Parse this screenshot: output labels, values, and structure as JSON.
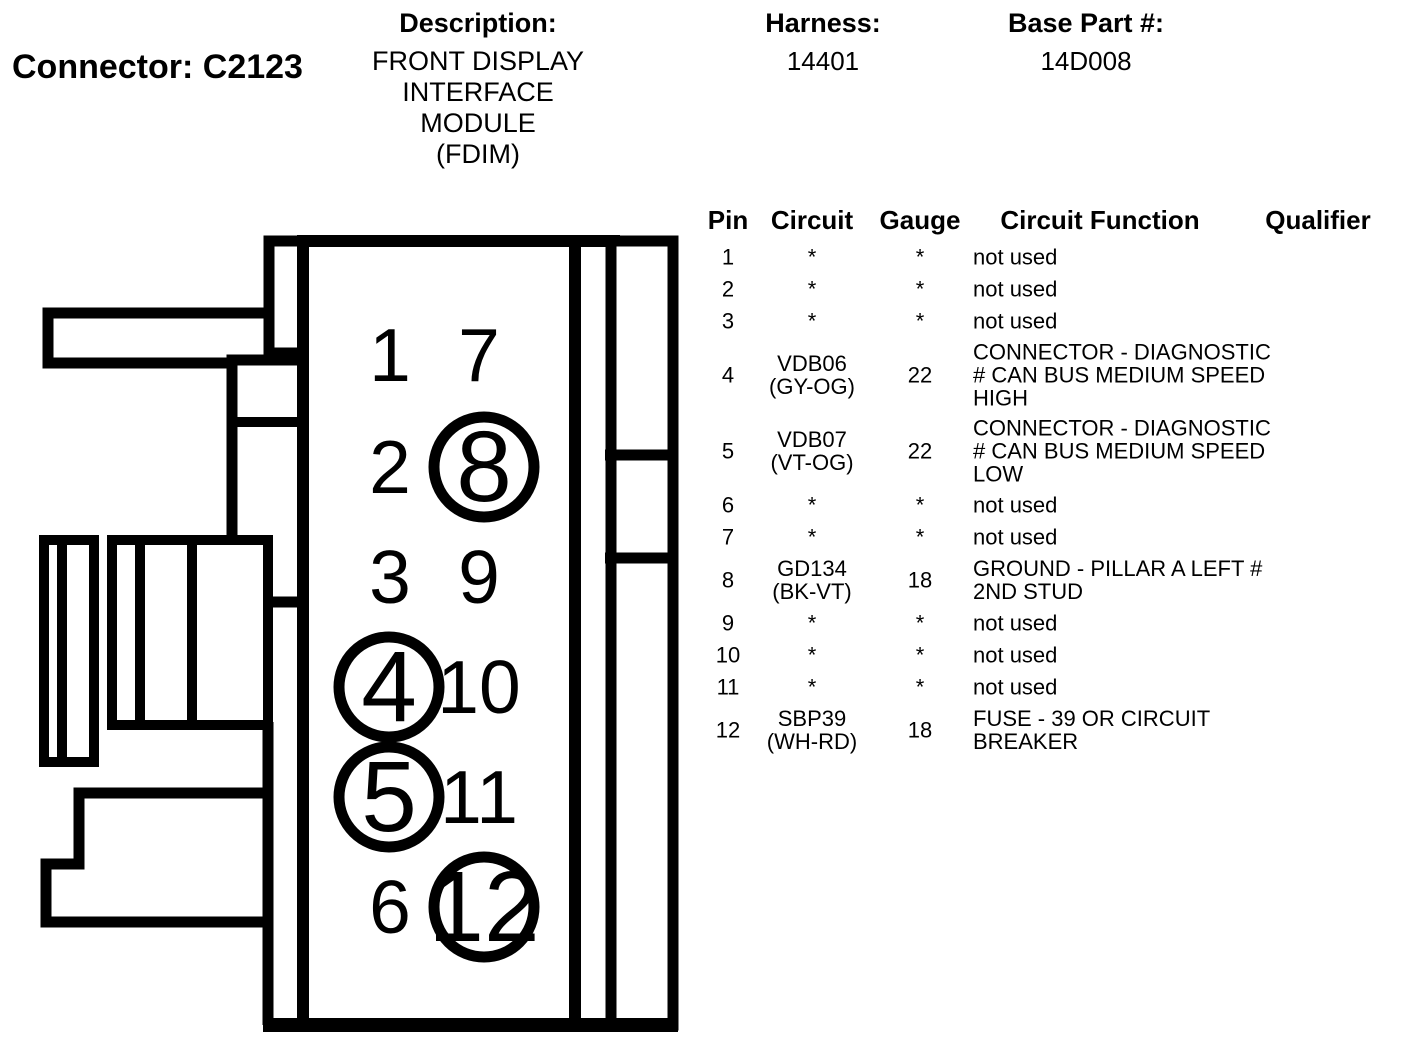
{
  "colors": {
    "ink": "#000000",
    "background": "#ffffff"
  },
  "header": {
    "connector_label": "Connector: C2123",
    "description_label": "Description:",
    "description_lines": [
      "FRONT DISPLAY",
      "INTERFACE MODULE",
      "(FDIM)"
    ],
    "harness_label": "Harness:",
    "harness_value": "14401",
    "base_part_label": "Base Part #:",
    "base_part_value": "14D008"
  },
  "pin_table": {
    "columns": [
      "Pin",
      "Circuit",
      "Gauge",
      "Circuit Function",
      "Qualifier"
    ],
    "rows": [
      {
        "pin": "1",
        "circuit_lines": [
          "*"
        ],
        "gauge": "*",
        "function_lines": [
          "not used"
        ],
        "qualifier": ""
      },
      {
        "pin": "2",
        "circuit_lines": [
          "*"
        ],
        "gauge": "*",
        "function_lines": [
          "not used"
        ],
        "qualifier": ""
      },
      {
        "pin": "3",
        "circuit_lines": [
          "*"
        ],
        "gauge": "*",
        "function_lines": [
          "not used"
        ],
        "qualifier": ""
      },
      {
        "pin": "4",
        "circuit_lines": [
          "VDB06",
          "(GY-OG)"
        ],
        "gauge": "22",
        "function_lines": [
          "CONNECTOR - DIAGNOSTIC",
          "# CAN BUS MEDIUM SPEED",
          "HIGH"
        ],
        "qualifier": ""
      },
      {
        "pin": "5",
        "circuit_lines": [
          "VDB07",
          "(VT-OG)"
        ],
        "gauge": "22",
        "function_lines": [
          "CONNECTOR - DIAGNOSTIC",
          "# CAN BUS MEDIUM SPEED",
          "LOW"
        ],
        "qualifier": ""
      },
      {
        "pin": "6",
        "circuit_lines": [
          "*"
        ],
        "gauge": "*",
        "function_lines": [
          "not used"
        ],
        "qualifier": ""
      },
      {
        "pin": "7",
        "circuit_lines": [
          "*"
        ],
        "gauge": "*",
        "function_lines": [
          "not used"
        ],
        "qualifier": ""
      },
      {
        "pin": "8",
        "circuit_lines": [
          "GD134",
          "(BK-VT)"
        ],
        "gauge": "18",
        "function_lines": [
          "GROUND - PILLAR A LEFT #",
          "2ND STUD"
        ],
        "qualifier": ""
      },
      {
        "pin": "9",
        "circuit_lines": [
          "*"
        ],
        "gauge": "*",
        "function_lines": [
          "not used"
        ],
        "qualifier": ""
      },
      {
        "pin": "10",
        "circuit_lines": [
          "*"
        ],
        "gauge": "*",
        "function_lines": [
          "not used"
        ],
        "qualifier": ""
      },
      {
        "pin": "11",
        "circuit_lines": [
          "*"
        ],
        "gauge": "*",
        "function_lines": [
          "not used"
        ],
        "qualifier": ""
      },
      {
        "pin": "12",
        "circuit_lines": [
          "SBP39",
          "(WH-RD)"
        ],
        "gauge": "18",
        "function_lines": [
          "FUSE - 39 OR CIRCUIT",
          "BREAKER"
        ],
        "qualifier": ""
      }
    ]
  },
  "connector_drawing": {
    "pins": [
      {
        "number": "1",
        "col": 0,
        "row": 0,
        "circled": false
      },
      {
        "number": "7",
        "col": 1,
        "row": 0,
        "circled": false
      },
      {
        "number": "2",
        "col": 0,
        "row": 1,
        "circled": false
      },
      {
        "number": "8",
        "col": 1,
        "row": 1,
        "circled": true
      },
      {
        "number": "3",
        "col": 0,
        "row": 2,
        "circled": false
      },
      {
        "number": "9",
        "col": 1,
        "row": 2,
        "circled": false
      },
      {
        "number": "4",
        "col": 0,
        "row": 3,
        "circled": true
      },
      {
        "number": "10",
        "col": 1,
        "row": 3,
        "circled": false
      },
      {
        "number": "5",
        "col": 0,
        "row": 4,
        "circled": true
      },
      {
        "number": "11",
        "col": 1,
        "row": 4,
        "circled": false
      },
      {
        "number": "6",
        "col": 0,
        "row": 5,
        "circled": false
      },
      {
        "number": "12",
        "col": 1,
        "row": 5,
        "circled": true
      }
    ]
  }
}
